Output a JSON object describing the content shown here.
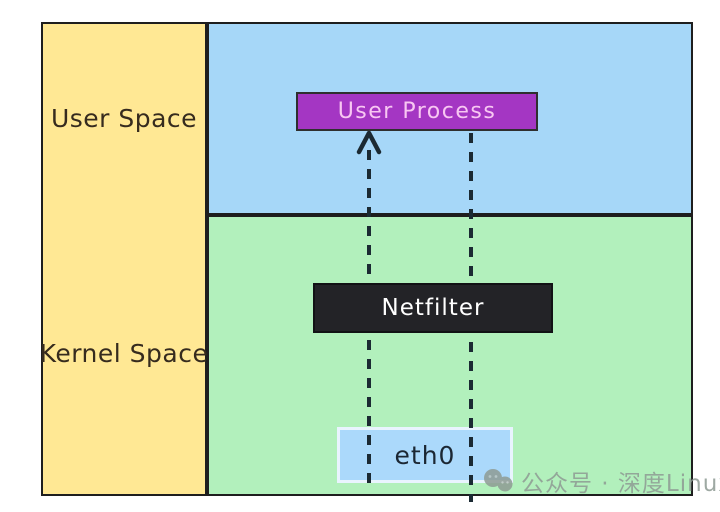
{
  "diagram": {
    "regions": {
      "user_space_label": "User Space",
      "kernel_space_label": "Kernel Space"
    },
    "nodes": {
      "user_process_label": "User Process",
      "netfilter_label": "Netfilter",
      "eth0_label": "eth0"
    },
    "flows": {
      "left_line": "dashed-arrow-up-from-eth0-through-netfilter-to-user-process",
      "right_line": "dashed-line-from-user-process-through-netfilter-to-eth0"
    },
    "watermark_text": "公众号 · 深度Linux",
    "icons": {
      "watermark_icon": "wechat-icon"
    },
    "colors": {
      "yellow_bg": "#ffe894",
      "blue_bg": "#a6d7f8",
      "green_bg": "#b2f0bc",
      "purple_bg": "#a436c3",
      "purple_text": "#f8c7f2",
      "dark_bg": "#232327",
      "dark_text": "#ffffff",
      "eth0_bg": "#abd9fb",
      "eth0_border": "#e9f4fe",
      "eth0_text": "#1b2733",
      "border": "#1e1e1e",
      "dash": "#1b2a33",
      "label_text": "#362b1e",
      "watermark": "#8e9b94"
    }
  }
}
